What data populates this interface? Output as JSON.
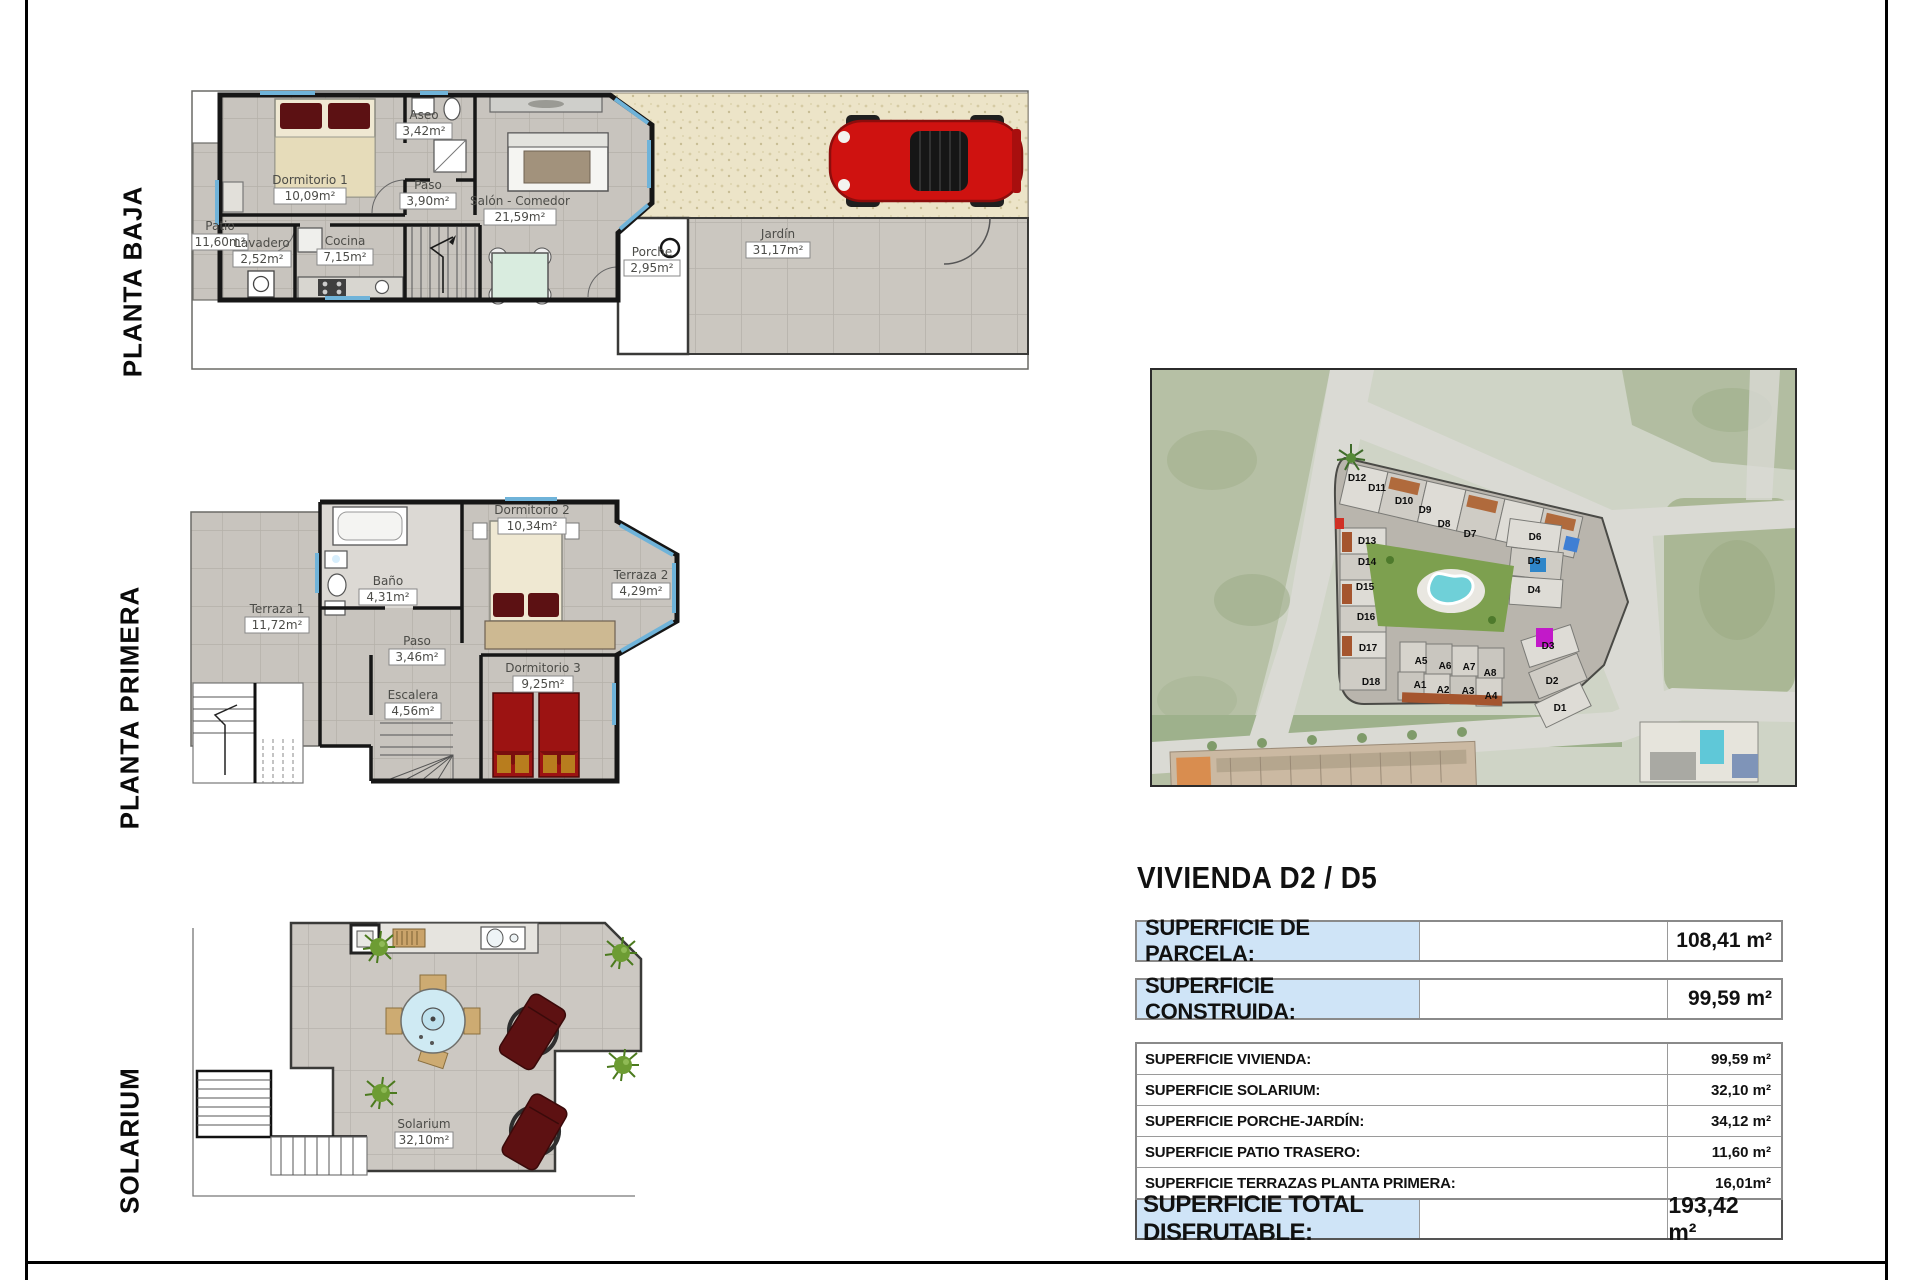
{
  "floors": [
    {
      "label": "PLANTA BAJA",
      "rooms": [
        {
          "name": "Dormitorio 1",
          "area": "10,09m²"
        },
        {
          "name": "Aseo",
          "area": "3,42m²"
        },
        {
          "name": "Paso",
          "area": "3,90m²"
        },
        {
          "name": "Salón - Comedor",
          "area": "21,59m²"
        },
        {
          "name": "Patio",
          "area": "11,60m²"
        },
        {
          "name": "Lavadero",
          "area": "2,52m²"
        },
        {
          "name": "Cocina",
          "area": "7,15m²"
        },
        {
          "name": "Porche",
          "area": "2,95m²"
        },
        {
          "name": "Jardín",
          "area": "31,17m²"
        }
      ]
    },
    {
      "label": "PLANTA PRIMERA",
      "rooms": [
        {
          "name": "Terraza 1",
          "area": "11,72m²"
        },
        {
          "name": "Baño",
          "area": "4,31m²"
        },
        {
          "name": "Dormitorio 2",
          "area": "10,34m²"
        },
        {
          "name": "Terraza 2",
          "area": "4,29m²"
        },
        {
          "name": "Paso",
          "area": "3,46m²"
        },
        {
          "name": "Escalera",
          "area": "4,56m²"
        },
        {
          "name": "Dormitorio 3",
          "area": "9,25m²"
        }
      ]
    },
    {
      "label": "SOLARIUM",
      "rooms": [
        {
          "name": "Solarium",
          "area": "32,10m²"
        }
      ]
    }
  ],
  "site_map": {
    "units": [
      "D12",
      "D11",
      "D10",
      "D9",
      "D8",
      "D7",
      "D13",
      "D14",
      "D15",
      "D16",
      "D17",
      "D18",
      "D6",
      "D5",
      "D4",
      "D3",
      "D2",
      "D1",
      "A5",
      "A6",
      "A7",
      "A8",
      "A1",
      "A2",
      "A3",
      "A4"
    ]
  },
  "summary": {
    "title": "VIVIENDA D2 / D5",
    "highlight_rows": [
      {
        "label": "SUPERFICIE DE PARCELA:",
        "value": "108,41 m²"
      },
      {
        "label": "SUPERFICIE CONSTRUIDA:",
        "value": "99,59 m²"
      }
    ],
    "detail_rows": [
      {
        "label": "SUPERFICIE VIVIENDA:",
        "value": "99,59 m²"
      },
      {
        "label": "SUPERFICIE SOLARIUM:",
        "value": "32,10 m²"
      },
      {
        "label": "SUPERFICIE PORCHE-JARDÍN:",
        "value": "34,12 m²"
      },
      {
        "label": "SUPERFICIE PATIO TRASERO:",
        "value": "11,60 m²"
      },
      {
        "label": "SUPERFICIE TERRAZAS PLANTA PRIMERA:",
        "value": "16,01m²"
      }
    ],
    "total_row": {
      "label": "SUPERFICIE TOTAL DISFRUTABLE:",
      "value": "193,42 m²"
    }
  },
  "colors": {
    "accent_blue": "#cfe4f7",
    "tile_grey": "#c8c4be",
    "wall_black": "#161616",
    "car_red": "#cf1210",
    "bed_maroon": "#5c1113",
    "field_green": "#b6c0a5",
    "pool_teal": "#6fd0d8"
  }
}
